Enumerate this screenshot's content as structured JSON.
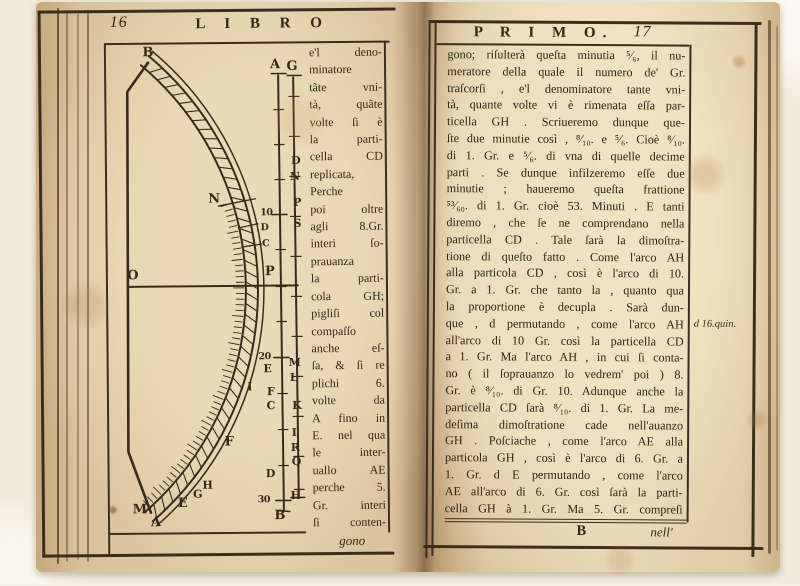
{
  "colors": {
    "paper": "#ddc8a4",
    "paper_light": "#e8d7b6",
    "ink": "#2f2718",
    "background": "#f2ecdd"
  },
  "page_left": {
    "page_number": "16",
    "running_title": "L I B R O",
    "catchword": "gono",
    "column_lines": [
      "e'l deno-",
      "minatore",
      "tãte vni-",
      "tà, quãte",
      "volte ſi è",
      "la parti-",
      "cella CD",
      "replicata,",
      "Perche",
      "poi oltre",
      "agli 8.Gr.",
      "interi ſo-",
      "prauanza",
      "la parti-",
      "cola GH;",
      "pigliſi col",
      "compaſſo",
      "anche eſ-",
      "ſa, & ſi re",
      "plichi 6.",
      "volte da",
      "A fino in",
      "E. nel qua",
      "le inter-",
      "uallo AE",
      "perche 5.",
      "Gr. interi",
      "ſi conten-"
    ],
    "diagram": {
      "description_labels": "arc instrument with graduated band and twin measuring scale",
      "labels": [
        {
          "t": "B",
          "x": 150,
          "y": 52,
          "s": "lg"
        },
        {
          "t": "N",
          "x": 215,
          "y": 199,
          "s": "lg"
        },
        {
          "t": "O",
          "x": 133,
          "y": 275,
          "s": "lg"
        },
        {
          "t": "P",
          "x": 270,
          "y": 272,
          "s": "lg"
        },
        {
          "t": "I",
          "x": 249,
          "y": 387,
          "s": "md"
        },
        {
          "t": "F",
          "x": 228,
          "y": 442,
          "s": "lg"
        },
        {
          "t": "H",
          "x": 206,
          "y": 485,
          "s": "md"
        },
        {
          "t": "G",
          "x": 196,
          "y": 494,
          "s": "md"
        },
        {
          "t": "E",
          "x": 181,
          "y": 503,
          "s": "lg"
        },
        {
          "t": "M",
          "x": 138,
          "y": 509,
          "s": "lg"
        },
        {
          "t": "A",
          "x": 154,
          "y": 522,
          "s": "lg"
        },
        {
          "t": "A",
          "x": 277,
          "y": 65,
          "s": "lg"
        },
        {
          "t": "G",
          "x": 294,
          "y": 67,
          "s": "lg"
        },
        {
          "t": "10",
          "x": 267,
          "y": 213,
          "s": "sm"
        },
        {
          "t": "D",
          "x": 265,
          "y": 228,
          "s": "sm"
        },
        {
          "t": "C",
          "x": 266,
          "y": 244,
          "s": "sm"
        },
        {
          "t": "20",
          "x": 264,
          "y": 357,
          "s": "sm"
        },
        {
          "t": "E",
          "x": 267,
          "y": 369,
          "s": "md"
        },
        {
          "t": "F",
          "x": 270,
          "y": 392,
          "s": "md"
        },
        {
          "t": "C",
          "x": 270,
          "y": 406,
          "s": "md"
        },
        {
          "t": "D",
          "x": 269,
          "y": 474,
          "s": "md"
        },
        {
          "t": "30",
          "x": 262,
          "y": 500,
          "s": "sm"
        },
        {
          "t": "B",
          "x": 278,
          "y": 516,
          "s": "lg"
        },
        {
          "t": "D",
          "x": 297,
          "y": 161,
          "s": "md"
        },
        {
          "t": "N",
          "x": 296,
          "y": 177,
          "s": "md"
        },
        {
          "t": "P",
          "x": 298,
          "y": 203,
          "s": "md"
        },
        {
          "t": "S",
          "x": 298,
          "y": 224,
          "s": "md"
        },
        {
          "t": "M",
          "x": 294,
          "y": 363,
          "s": "md"
        },
        {
          "t": "L",
          "x": 293,
          "y": 378,
          "s": "md"
        },
        {
          "t": "K",
          "x": 296,
          "y": 406,
          "s": "md"
        },
        {
          "t": "I",
          "x": 293,
          "y": 433,
          "s": "md"
        },
        {
          "t": "R",
          "x": 294,
          "y": 448,
          "s": "md"
        },
        {
          "t": "Q",
          "x": 295,
          "y": 462,
          "s": "md"
        },
        {
          "t": "H",
          "x": 294,
          "y": 496,
          "s": "md"
        }
      ]
    }
  },
  "page_right": {
    "running_title": "P R I M O.",
    "page_number": "17",
    "lines": [
      "gono; riſulterà queſta minutia ⁵⁄₆, il nu-",
      "meratore della quale il numero de' Gr.",
      "traſcorſi , e'l denominatore tante vni-",
      "tà, quante volte vi è rimenata eſſa par-",
      "ticella GH . Scriueremo dunque que-",
      "ſte due minutie così , ⁸⁄₁₀. e ⁵⁄₆. Cioè ⁸⁄₁₀.",
      "di 1. Gr. e ⁵⁄₆. di vna di quelle decime",
      "parti . Se dunque infilzeremo eſſe due",
      "minutie ; haueremo queſta frattione",
      "⁵³⁄₆₀. di 1. Gr. cioè 53. Minuti . E tanti",
      "diremo , che ſe ne comprendano nella",
      "particella CD . Tale ſarà la dimoſtra-",
      "tione di queſto fatto . Come l'arco AH",
      "alla particola CD , così è l'arco di 10.",
      "Gr. a 1. Gr. che tanto la , quanto qua",
      "la proportione è decupla . Sarà dun-",
      "que , d permutando , come l'arco AH",
      "all'arco di 10 Gr. così la particella CD",
      "a 1. Gr. Ma l'arco AH , in cui ſi conta-",
      "no ( il ſoprauanzo lo vedrem' poi ) 8.",
      "Gr. è ⁸⁄₁₀. di Gr. 10. Adunque anche la",
      "particella CD ſarà ⁸⁄₁₀. di 1. Gr. La me-",
      "deſima dimoſtratione cade nell'auanzo",
      "GH . Poſciache , come l'arco AE alla",
      "particola GH , così è l'arco di 6. Gr. a",
      "1. Gr. d E permutando , come l'arco",
      "AE all'arco di 6. Gr. così ſarà la parti-",
      "cella GH à 1. Gr. Ma 5. Gr. compreſi"
    ],
    "margin_note": "d 16.quin.",
    "signature": "B",
    "catchword": "nell'"
  }
}
